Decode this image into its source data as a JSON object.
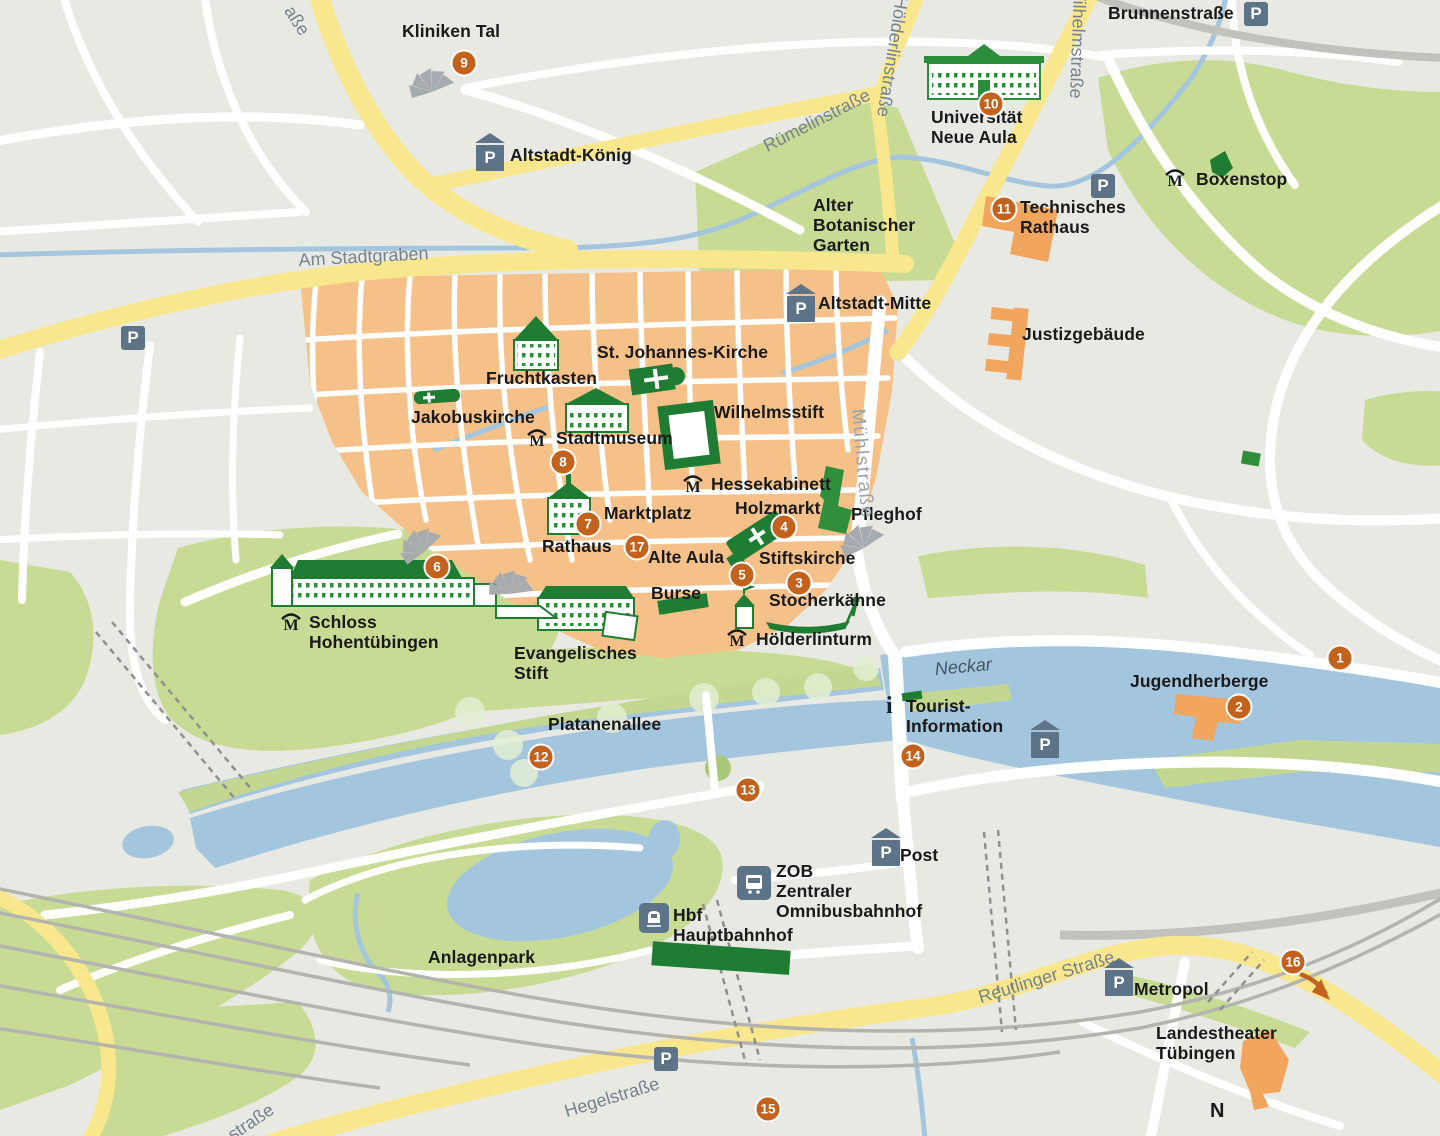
{
  "map": {
    "name": "Tübingen Altstadt tourist map"
  },
  "colors": {
    "background": "#e9e9e3",
    "old_town": "#f6c189",
    "park_green": "#c7db94",
    "island_green": "#c3d791",
    "water_blue": "#a3c6de",
    "street_yellow": "#f8e78d",
    "street_white": "#ffffff",
    "railway_gray": "#b4b4af",
    "building_green": "#1f7d33",
    "building_orange": "#f2a55d",
    "marker_orange": "#c2621c",
    "parking_slate": "#5d7488",
    "street_label": "#76828e",
    "poi_label": "#1a1a1a"
  },
  "glyphs": {
    "parking": "P",
    "museum": "M",
    "info": "i",
    "compass": "N"
  },
  "markers": [
    {
      "n": "1",
      "x": 1340,
      "y": 658
    },
    {
      "n": "2",
      "x": 1239,
      "y": 707
    },
    {
      "n": "3",
      "x": 799,
      "y": 583
    },
    {
      "n": "4",
      "x": 784,
      "y": 527
    },
    {
      "n": "5",
      "x": 742,
      "y": 575
    },
    {
      "n": "6",
      "x": 437,
      "y": 567
    },
    {
      "n": "7",
      "x": 588,
      "y": 524
    },
    {
      "n": "8",
      "x": 563,
      "y": 462
    },
    {
      "n": "9",
      "x": 464,
      "y": 63
    },
    {
      "n": "10",
      "x": 991,
      "y": 104
    },
    {
      "n": "11",
      "x": 1004,
      "y": 209
    },
    {
      "n": "12",
      "x": 541,
      "y": 757
    },
    {
      "n": "13",
      "x": 748,
      "y": 790
    },
    {
      "n": "14",
      "x": 913,
      "y": 756
    },
    {
      "n": "15",
      "x": 768,
      "y": 1109
    },
    {
      "n": "16",
      "x": 1293,
      "y": 962
    },
    {
      "n": "17",
      "x": 637,
      "y": 547
    }
  ],
  "labels": [
    {
      "id": "kliniken-tal",
      "text": "Kliniken Tal",
      "x": 402,
      "y": 22,
      "cls": "poi"
    },
    {
      "id": "altstadt-koenig",
      "text": "Altstadt-König",
      "x": 510,
      "y": 146,
      "cls": "poi"
    },
    {
      "id": "brunnenstrasse",
      "text": "Brunnenstraße",
      "x": 1108,
      "y": 4,
      "cls": "poi"
    },
    {
      "id": "boxenstop",
      "text": "Boxenstop",
      "x": 1196,
      "y": 170,
      "cls": "poi"
    },
    {
      "id": "universitaet-neue-aula",
      "text": "Universität\nNeue Aula",
      "x": 931,
      "y": 108,
      "cls": "poi"
    },
    {
      "id": "technisches-rathaus",
      "text": "Technisches\nRathaus",
      "x": 1020,
      "y": 198,
      "cls": "poi"
    },
    {
      "id": "alter-botanischer-garten",
      "text": "Alter\nBotanischer\nGarten",
      "x": 813,
      "y": 196,
      "cls": "poi"
    },
    {
      "id": "altstadt-mitte",
      "text": "Altstadt-Mitte",
      "x": 818,
      "y": 294,
      "cls": "poi"
    },
    {
      "id": "justizgebaeude",
      "text": "Justizgebäude",
      "x": 1022,
      "y": 325,
      "cls": "poi"
    },
    {
      "id": "st-johannes-kirche",
      "text": "St. Johannes-Kirche",
      "x": 597,
      "y": 343,
      "cls": "poi"
    },
    {
      "id": "fruchtkasten",
      "text": "Fruchtkasten",
      "x": 486,
      "y": 369,
      "cls": "poi"
    },
    {
      "id": "jakobuskirche",
      "text": "Jakobuskirche",
      "x": 411,
      "y": 408,
      "cls": "poi"
    },
    {
      "id": "wilhelmsstift",
      "text": "Wilhelmsstift",
      "x": 714,
      "y": 403,
      "cls": "poi"
    },
    {
      "id": "stadtmuseum",
      "text": "Stadtmuseum",
      "x": 556,
      "y": 429,
      "cls": "poi"
    },
    {
      "id": "hessekabinett",
      "text": "Hessekabinett",
      "x": 711,
      "y": 475,
      "cls": "poi"
    },
    {
      "id": "holzmarkt",
      "text": "Holzmarkt",
      "x": 735,
      "y": 499,
      "cls": "poi"
    },
    {
      "id": "pfleghof",
      "text": "Pfleghof",
      "x": 851,
      "y": 505,
      "cls": "poi"
    },
    {
      "id": "marktplatz",
      "text": "Marktplatz",
      "x": 604,
      "y": 504,
      "cls": "poi"
    },
    {
      "id": "rathaus",
      "text": "Rathaus",
      "x": 542,
      "y": 537,
      "cls": "poi"
    },
    {
      "id": "alte-aula",
      "text": "Alte Aula",
      "x": 648,
      "y": 548,
      "cls": "poi"
    },
    {
      "id": "stiftskirche",
      "text": "Stiftskirche",
      "x": 759,
      "y": 549,
      "cls": "poi"
    },
    {
      "id": "burse",
      "text": "Burse",
      "x": 651,
      "y": 584,
      "cls": "poi"
    },
    {
      "id": "stocherkaehne",
      "text": "Stocherkähne",
      "x": 769,
      "y": 591,
      "cls": "poi"
    },
    {
      "id": "hoelderlinturm",
      "text": "Hölderlinturm",
      "x": 756,
      "y": 630,
      "cls": "poi"
    },
    {
      "id": "schloss-hohentuebingen",
      "text": "Schloss\nHohentübingen",
      "x": 309,
      "y": 613,
      "cls": "poi"
    },
    {
      "id": "evangelisches-stift",
      "text": "Evangelisches\nStift",
      "x": 514,
      "y": 644,
      "cls": "poi"
    },
    {
      "id": "platanenallee",
      "text": "Platanenallee",
      "x": 548,
      "y": 715,
      "cls": "poi"
    },
    {
      "id": "jugendherberge",
      "text": "Jugendherberge",
      "x": 1130,
      "y": 672,
      "cls": "poi"
    },
    {
      "id": "tourist-information",
      "text": "Tourist-\nInformation",
      "x": 906,
      "y": 697,
      "cls": "poi"
    },
    {
      "id": "post",
      "text": "Post",
      "x": 900,
      "y": 846,
      "cls": "poi"
    },
    {
      "id": "zob",
      "text": "ZOB\nZentraler\nOmnibusbahnhof",
      "x": 776,
      "y": 862,
      "cls": "poi"
    },
    {
      "id": "hbf",
      "text": "Hbf\nHauptbahnhof",
      "x": 673,
      "y": 906,
      "cls": "poi"
    },
    {
      "id": "anlagenpark",
      "text": "Anlagenpark",
      "x": 428,
      "y": 948,
      "cls": "poi"
    },
    {
      "id": "metropol",
      "text": "Metropol",
      "x": 1134,
      "y": 980,
      "cls": "poi"
    },
    {
      "id": "landestheater-tuebingen",
      "text": "Landestheater\nTübingen",
      "x": 1156,
      "y": 1024,
      "cls": "poi"
    },
    {
      "id": "compass-n",
      "text": "N",
      "x": 1210,
      "y": 1100,
      "cls": "poi",
      "size": 20
    },
    {
      "id": "am-stadtgraben",
      "text": "Am Stadtgraben",
      "x": 298,
      "y": 250,
      "cls": "street",
      "rot": -3
    },
    {
      "id": "ruemelinstrasse",
      "text": "Rümelinstraße",
      "x": 760,
      "y": 138,
      "cls": "street",
      "rot": -27
    },
    {
      "id": "hoelderlinstrasse",
      "text": "Hölderlinstraße",
      "x": 912,
      "y": -2,
      "cls": "street",
      "rot": 99
    },
    {
      "id": "wilhelmstrasse",
      "text": "Wilhelmstraße",
      "x": 1090,
      "y": -16,
      "cls": "street",
      "rot": 92
    },
    {
      "id": "muehlstrasse",
      "text": "Mühlstraße",
      "x": 868,
      "y": 408,
      "cls": "street-light",
      "rot": 85
    },
    {
      "id": "reutlinger-strasse",
      "text": "Reutlinger Straße",
      "x": 976,
      "y": 988,
      "cls": "street",
      "rot": -17
    },
    {
      "id": "hegelstrasse",
      "text": "Hegelstraße",
      "x": 562,
      "y": 1102,
      "cls": "street",
      "rot": -17
    },
    {
      "id": "strasse-bottom-left",
      "text": "straße",
      "x": 224,
      "y": 1128,
      "cls": "street",
      "rot": -34
    },
    {
      "id": "strasse-top-left",
      "text": "aße",
      "x": 297,
      "y": 2,
      "cls": "street",
      "rot": 57
    },
    {
      "id": "neckar-river",
      "text": "Neckar",
      "x": 934,
      "y": 659,
      "cls": "water",
      "rot": -5
    }
  ],
  "parking": [
    {
      "v": "garage",
      "x": 475,
      "y": 133,
      "near": "Altstadt-König"
    },
    {
      "v": "lot",
      "x": 121,
      "y": 326,
      "near": ""
    },
    {
      "v": "lot",
      "x": 1244,
      "y": 2,
      "near": "Brunnenstraße"
    },
    {
      "v": "lot",
      "x": 1091,
      "y": 174,
      "near": "Technisches Rathaus"
    },
    {
      "v": "garage",
      "x": 786,
      "y": 284,
      "near": "Altstadt-Mitte"
    },
    {
      "v": "garage",
      "x": 1030,
      "y": 720,
      "near": "Neckar"
    },
    {
      "v": "garage",
      "x": 871,
      "y": 828,
      "near": "Post"
    },
    {
      "v": "garage",
      "x": 1104,
      "y": 958,
      "near": "Metropol"
    },
    {
      "v": "lot",
      "x": 654,
      "y": 1047,
      "near": "Hegelstraße"
    }
  ],
  "museum_icons": [
    {
      "x": 1164,
      "y": 168,
      "near": "Boxenstop"
    },
    {
      "x": 526,
      "y": 428,
      "near": "Stadtmuseum"
    },
    {
      "x": 682,
      "y": 474,
      "near": "Hessekabinett"
    },
    {
      "x": 280,
      "y": 612,
      "near": "Schloss Hohentübingen"
    },
    {
      "x": 726,
      "y": 628,
      "near": "Hölderlinturm"
    }
  ],
  "info_icon": {
    "x": 886,
    "y": 694,
    "near": "Tourist-Information"
  },
  "transit_icons": [
    {
      "type": "bus",
      "x": 737,
      "y": 866,
      "near": "ZOB"
    },
    {
      "type": "train",
      "x": 639,
      "y": 903,
      "near": "Hbf"
    }
  ]
}
